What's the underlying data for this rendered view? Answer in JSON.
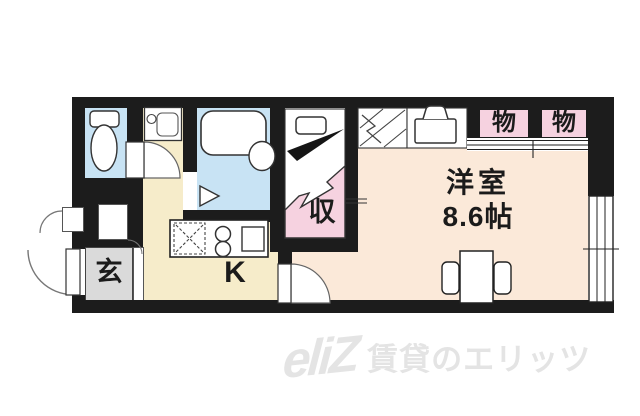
{
  "meta": {
    "type": "japanese-apartment-floor-plan"
  },
  "palette": {
    "wall": "#1c1c1c",
    "wet-blue": "#c8e3f4",
    "kitchen-cream": "#f6ecca",
    "room-peach": "#fbe9d9",
    "closet-pink": "#f6d2e0",
    "genkan-gray": "#dadada",
    "watermark-gray": "#e4e4e4"
  },
  "rooms": {
    "western_room": {
      "label": "洋室",
      "size": "8.6帖"
    },
    "kitchen": {
      "label": "K"
    },
    "entrance": {
      "label": "玄"
    },
    "closet": {
      "label": "収"
    },
    "storage_left": {
      "label": "物"
    },
    "storage_right": {
      "label": "物"
    }
  },
  "watermark": {
    "logo": "eliZ",
    "text": "賃貸のエリッツ"
  },
  "icons": {
    "toilet": "toilet-icon",
    "washbasin": "washbasin-icon",
    "bathtub": "bathtub-icon",
    "bath_door": "folding-door-triangle-icon",
    "washer_pan": "washer-pan-x-icon",
    "stove": "two-burner-stove-icon",
    "kitchen_sink": "kitchen-sink-icon",
    "loft_ladder": "loft-ladder-hatch-icon",
    "washing_machine": "washing-machine-icon",
    "closet_shelf": "closet-shelf-icon",
    "table_chairs": "table-with-chairs-icon",
    "window": "sliding-window-icon",
    "door_arc": "door-swing-arc-icon"
  }
}
